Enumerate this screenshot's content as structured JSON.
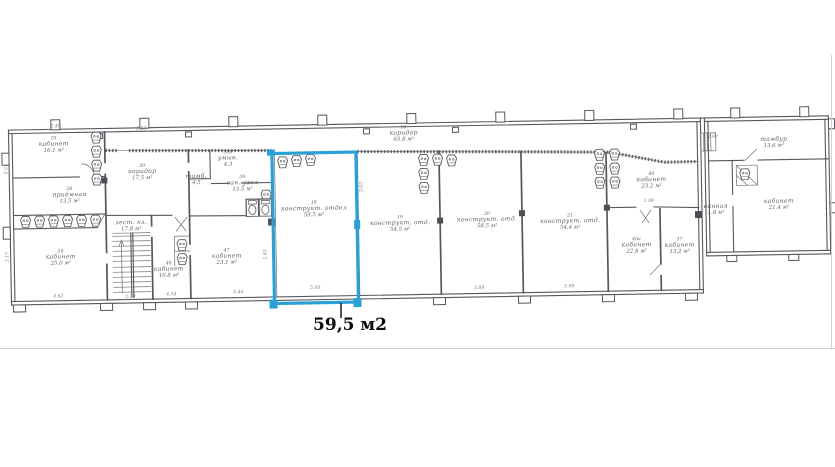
{
  "annotation": {
    "area_label": "59,5 м2"
  },
  "colors": {
    "highlight": "#2aa0d5",
    "ink": "#56565e"
  },
  "plan": {
    "rooms": [
      {
        "number": "25",
        "name": "кабинет",
        "area": "16.1 м²",
        "x": 55,
        "y": 139
      },
      {
        "number": "26",
        "name": "приёмная",
        "area": "13.5 м²",
        "x": 70,
        "y": 190
      },
      {
        "number": "24",
        "name": "кабинет",
        "area": "25.0 м²",
        "x": 60,
        "y": 252
      },
      {
        "number": "30",
        "name": "коридор",
        "area": "17.5 м²",
        "x": 143,
        "y": 168
      },
      {
        "number": "",
        "name": "лест. кл.",
        "area": "17.8 м²",
        "x": 131,
        "y": 219
      },
      {
        "number": "48",
        "name": "кабинет",
        "area": "10.8 м²",
        "x": 168,
        "y": 266
      },
      {
        "number": "47",
        "name": "кабинет",
        "area": "23.1 м²",
        "x": 226,
        "y": 254
      },
      {
        "number": "",
        "name": "тамб.",
        "area": "4.5",
        "x": 197,
        "y": 174
      },
      {
        "number": "38а",
        "name": "умыв.",
        "area": "4.3",
        "x": 229,
        "y": 156
      },
      {
        "number": "39",
        "name": "сан. узел",
        "area": "13.5 м²",
        "x": 243,
        "y": 181
      },
      {
        "number": "16",
        "name": "коридор",
        "area": "65.8 м²",
        "x": 405,
        "y": 134
      },
      {
        "number": "18",
        "name": "конструкт. отдел",
        "area": "59.5 м²",
        "x": 314,
        "y": 208,
        "highlight": true
      },
      {
        "number": "19",
        "name": "конструкт. отд.",
        "area": "54.5 м²",
        "x": 400,
        "y": 224
      },
      {
        "number": "20",
        "name": "конструкт. отд.",
        "area": "58.5 м²",
        "x": 487,
        "y": 222
      },
      {
        "number": "21",
        "name": "конструкт. отд.",
        "area": "54.4 м²",
        "x": 570,
        "y": 225
      },
      {
        "number": "40",
        "name": "кабинет",
        "area": "23.2 м²",
        "x": 652,
        "y": 185
      },
      {
        "number": "46а",
        "name": "кабинет",
        "area": "22.8 м²",
        "x": 636,
        "y": 250
      },
      {
        "number": "37",
        "name": "кабинет",
        "area": "13.2 м²",
        "x": 679,
        "y": 251
      },
      {
        "number": "",
        "name": "тамбур",
        "area": "13.6 м²",
        "x": 775,
        "y": 147
      },
      {
        "number": "",
        "name": "ванная",
        "area": "1.8 м²",
        "x": 716,
        "y": 213
      },
      {
        "number": "",
        "name": "кабинет",
        "area": "21.4 м²",
        "x": 779,
        "y": 209
      }
    ],
    "dims": [
      {
        "v": "2.48",
        "x": 57,
        "y": 121
      },
      {
        "v": "2.53",
        "x": 143,
        "y": 125
      },
      {
        "v": "2.21",
        "x": 8,
        "y": 162,
        "r": -90
      },
      {
        "v": "3.17",
        "x": 8,
        "y": 250,
        "r": -90
      },
      {
        "v": "4.62",
        "x": 57,
        "y": 291
      },
      {
        "v": "2.38",
        "x": 129,
        "y": 293
      },
      {
        "v": "4.54",
        "x": 170,
        "y": 291
      },
      {
        "v": "5.44",
        "x": 237,
        "y": 290
      },
      {
        "v": "5.60",
        "x": 314,
        "y": 287
      },
      {
        "v": "5.93",
        "x": 266,
        "y": 252,
        "r": -90
      },
      {
        "v": "3.03",
        "x": 363,
        "y": 186,
        "r": -90
      },
      {
        "v": "5.88",
        "x": 478,
        "y": 290
      },
      {
        "v": "5.90",
        "x": 568,
        "y": 290
      },
      {
        "v": "1.08",
        "x": 649,
        "y": 206
      },
      {
        "v": "2.00",
        "x": 714,
        "y": 143
      }
    ]
  }
}
